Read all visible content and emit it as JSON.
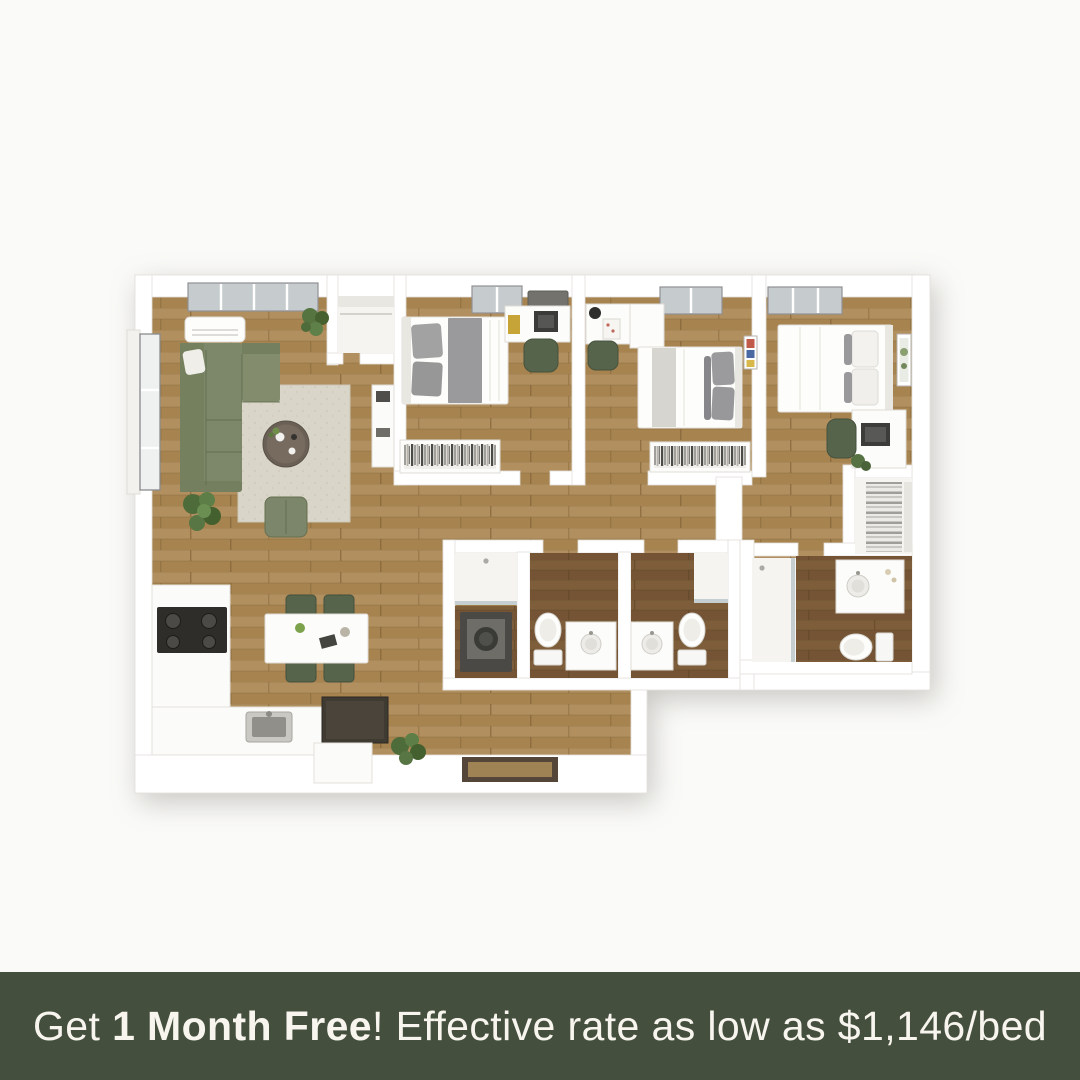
{
  "banner": {
    "text_prefix": "Get ",
    "text_bold": "1 Month Free",
    "text_suffix": "! Effective rate as low as $1,146/bed"
  },
  "colors": {
    "banner_bg": "#444f3e",
    "banner_text": "#f7f5ee",
    "page_bg": "#fafaf8",
    "wall": "#ffffff",
    "wall_edge": "#e3e0da",
    "floor": "#ad8a58",
    "floor_dark": "#7b5b38",
    "rug": "#d9d5c9",
    "sofa_green": "#7d886a",
    "chair_green": "#57644c",
    "appliance_dark": "#2e2d2a",
    "glass": "#c6cccd"
  },
  "floorplan": {
    "type": "3d-top-down-floor-plan",
    "rooms": [
      "living-room",
      "dining-area",
      "kitchen",
      "bedroom-1",
      "bedroom-2",
      "bedroom-3",
      "bathroom-1",
      "bathroom-2",
      "bathroom-3",
      "laundry-closet",
      "entry-closet",
      "walk-in-closet"
    ]
  }
}
